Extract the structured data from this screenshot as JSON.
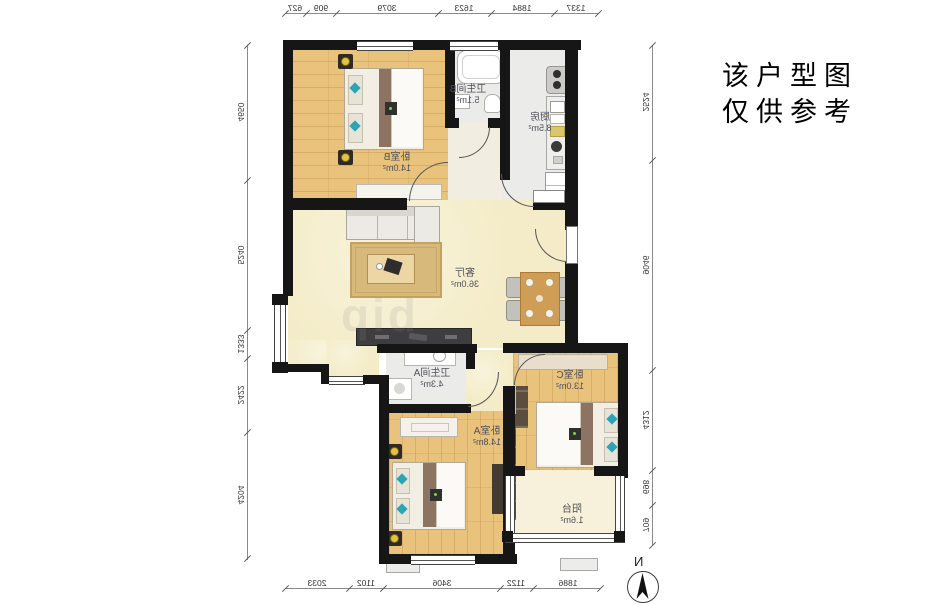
{
  "note": {
    "line1": "该户型图",
    "line2": "仅供参考"
  },
  "compass": {
    "label": "N"
  },
  "watermark": {
    "text": "bip"
  },
  "rooms": {
    "bedroom_b": {
      "label": "卧室B",
      "area": "14.0m²"
    },
    "bathroom_b": {
      "label": "卫生间B",
      "area": "5.1m²"
    },
    "kitchen": {
      "label": "厨房",
      "area": "8.5m²"
    },
    "living": {
      "label": "客厅",
      "area": "36.0m²"
    },
    "bathroom_a": {
      "label": "卫生间A",
      "area": "4.3m²"
    },
    "bedroom_a": {
      "label": "卧室A",
      "area": "14.8m²"
    },
    "bedroom_c": {
      "label": "卧室C",
      "area": "13.0m²"
    },
    "balcony": {
      "label": "阳台",
      "area": "1.6m²"
    }
  },
  "dimensions": {
    "top": [
      "627",
      "909",
      "3079",
      "1623",
      "1884",
      "1337"
    ],
    "bottom": [
      "2033",
      "1102",
      "3406",
      "1122",
      "1886"
    ],
    "left": [
      "4650",
      "5240",
      "1333",
      "2422",
      "4204"
    ],
    "right": [
      "2524",
      "9046",
      "4312",
      "698",
      "709"
    ]
  },
  "colors": {
    "wall": "#161616",
    "wood_floor": "#e9c27c",
    "living_floor": "#f4ecc8",
    "tile_floor": "#ebebe9",
    "teal_accent": "#2ba4b6",
    "lamp_yellow": "#e6c33b",
    "table_wood": "#cf9d55"
  }
}
